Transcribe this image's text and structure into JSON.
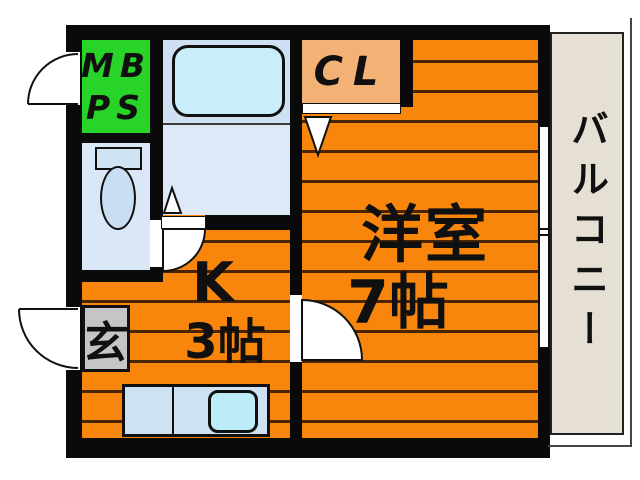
{
  "plan_type": "floor-plan",
  "rooms": {
    "meter_box": {
      "line1": "MB",
      "line2": "PS"
    },
    "closet": {
      "label": "CL"
    },
    "main_room": {
      "name": "洋室",
      "size": "7帖"
    },
    "kitchen": {
      "name": "K",
      "size": "3帖"
    },
    "entrance": {
      "label": "玄"
    },
    "balcony": {
      "label": "バルコニー"
    }
  },
  "colors": {
    "orange": "#f8860d",
    "stripe": "#4a2503",
    "wall": "#0a0a0a",
    "green": "#28d428",
    "peach": "#f3b175",
    "bath1": "#cfe0f2",
    "bath2": "#dde9f7",
    "tub": "#c9edfa",
    "toiletbg": "#d9e7f6",
    "fixture": "#cfe3f5",
    "bowl": "#c9def3",
    "gray": "#c5c5c5",
    "counter": "#cfe2f4",
    "sink": "#bdebf8",
    "balconybg": "#e6dfd3",
    "outline": "#444444"
  }
}
